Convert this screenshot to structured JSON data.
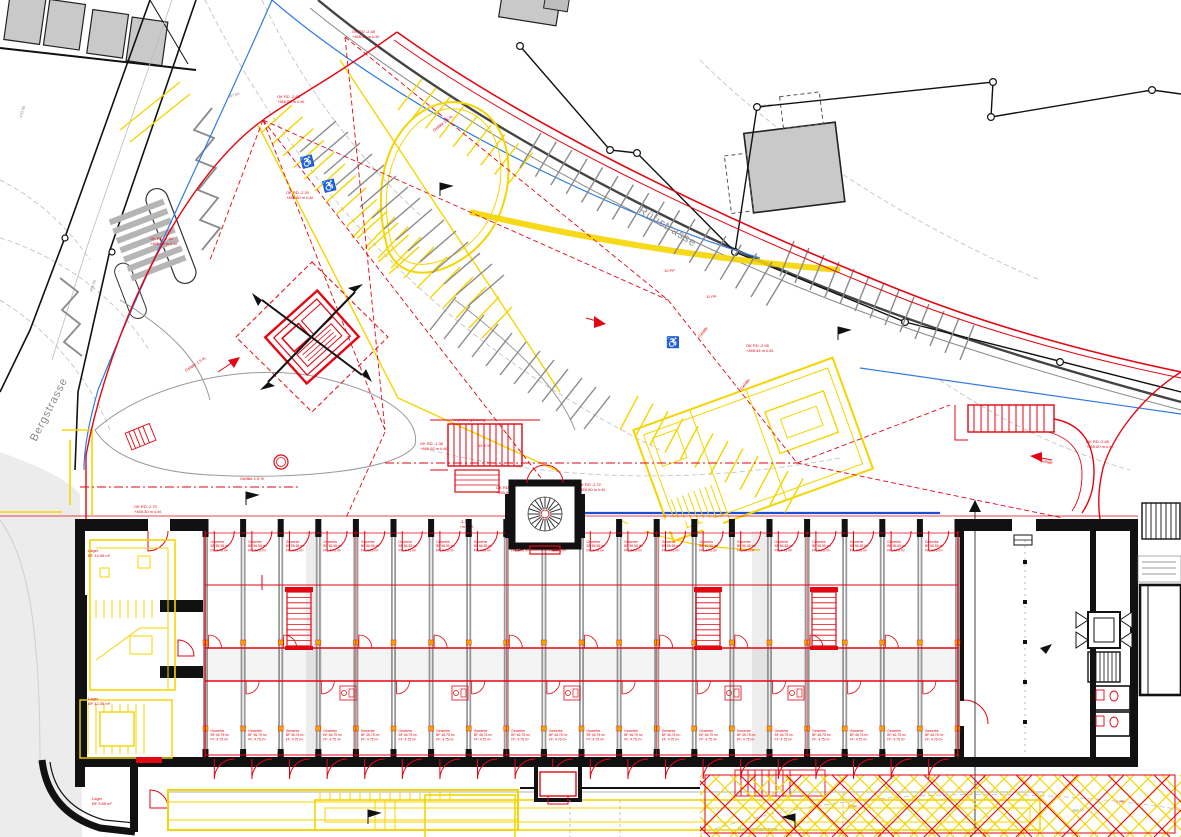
{
  "drawing": {
    "kind": "site-and-floor-plan",
    "colors": {
      "markup_red": "#e30613",
      "new_yellow": "#f5d500",
      "existing_gray": "#9b9b9b",
      "utility_blue": "#2f7bdf",
      "wall_black": "#111111"
    }
  },
  "streets": {
    "ruefistrasse": "Rüfistrasse",
    "bergstrasse": "Bergstrasse",
    "panoramastrasse": "Panoramastrasse"
  },
  "slopes": {
    "g1": "Gefälle 1.5 %",
    "g2": "Gefälle 1.5 %",
    "g3": "Gefälle 1.5 %",
    "g4": "Gefälle",
    "g5": "Gefälle",
    "g6": "Gefälle",
    "ramp": "19.5 %",
    "note": "Vorplatzergänzung"
  },
  "parking": {
    "p1": "10 PP",
    "p2": "11 PP",
    "p3": "6 PP",
    "p4": "6 PP"
  },
  "contours": {
    "c470": "470.00",
    "c469": "469.00",
    "c4685": "468.50",
    "c467": "467.00",
    "c466": "466.00",
    "c468": "468.00"
  },
  "ann": {
    "a1": [
      "OK RD -2.48",
      "+465.50 m ü.M."
    ],
    "a2": [
      "OK RD -2.65",
      "+465.00 m ü.M."
    ],
    "a3": [
      "OK RD -2.60",
      "+465.50 m ü.M."
    ],
    "a4": [
      "OK RD -2.20",
      "+465.80 m ü.M."
    ],
    "a5": [
      "OK RD -1.38",
      "+466.02 m ü.M."
    ],
    "a6": [
      "OK RD -1.93",
      "+465.99 m ü.M."
    ],
    "a7": [
      "OK RD -2.72",
      "+465.60 m ü.M."
    ],
    "a8": [
      "OK RD -3.10",
      "+467.05 m ü.M."
    ],
    "a9": [
      "OK RD -2.65",
      "+465.60 m ü.M."
    ],
    "a10": [
      "OK RD -2.05",
      "+465.44 m ü.M."
    ],
    "a11": [
      "OK RD -2.70",
      "+465.30 m ü.M."
    ]
  },
  "building": {
    "bays": {
      "count": 20,
      "top_label": [
        "Gewerbe",
        "BF 56.55 m²",
        "FF: 4.75 m²"
      ],
      "bottom_label": [
        "Gewerbe",
        "BF 46.75 m²",
        "FF: 4.75 m²"
      ]
    },
    "rooms": {
      "lager1": "Lager",
      "lager1_area": "BF 14.05 m²",
      "lager2": "Lager",
      "lager2_area": "BF 12.35 m²",
      "lager3": "Lager",
      "lager3_area": "BF 9.85 m²"
    }
  }
}
